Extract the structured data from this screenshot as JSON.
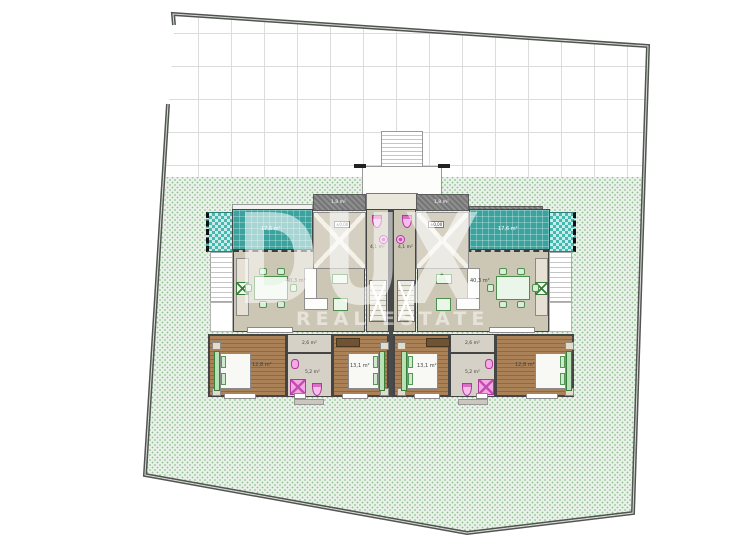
{
  "watermark": {
    "brand": "DUX",
    "tagline": "REAL ESTATE"
  },
  "units": {
    "left": {
      "terrace_area": "17,6 m²",
      "canopy_area": "1,8 m²",
      "elevation": "±0,00",
      "living_area": "40,3 m²",
      "hall_area": "4,1 m²",
      "hallway_area": "2,6 m²",
      "bathroom_area": "5,2 m²",
      "bedroom_inner_area": "13,1 m²",
      "bedroom_outer_area": "12,8 m²"
    },
    "right": {
      "terrace_area": "17,6 m²",
      "canopy_area": "1,8 m²",
      "elevation": "±0,00",
      "living_area": "40,3 m²",
      "hall_area": "4,1 m²",
      "hallway_area": "2,6 m²",
      "bathroom_area": "5,2 m²",
      "bedroom_inner_area": "13,1 m²",
      "bedroom_outer_area": "12,8 m²"
    }
  },
  "palette": {
    "terrace_teal": "#3ba39e",
    "pool_teal": "#45b8b2",
    "lawn_green": "#e9f2e9",
    "lawn_dot_green": "#92bf92",
    "wood_brown": "#a27a50",
    "fixture_pink": "#f3a9e6",
    "furniture_green": "#4e8f4e",
    "boundary_gray": "#50554f"
  }
}
